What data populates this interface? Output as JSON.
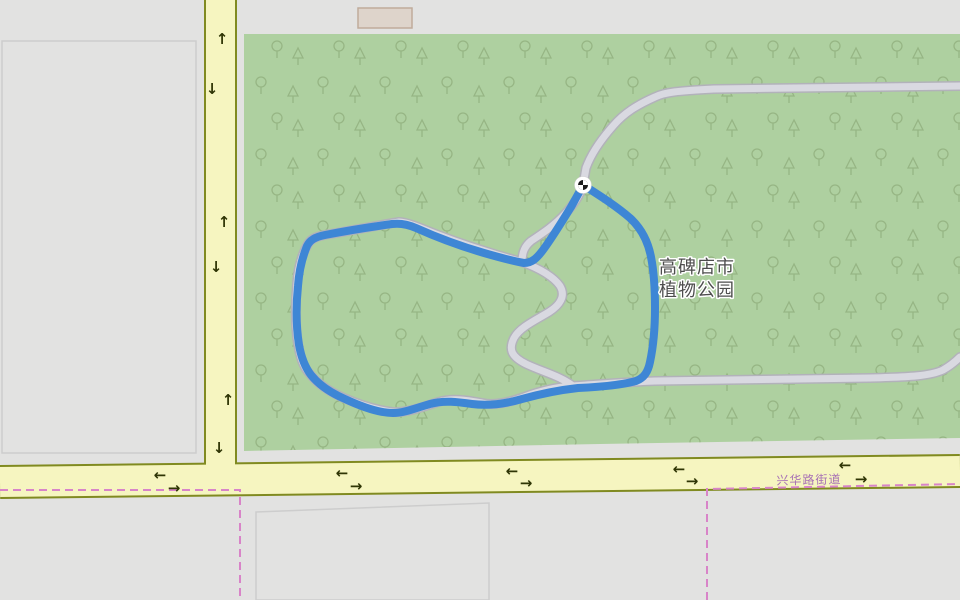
{
  "map": {
    "park_label": {
      "line1": "高碑店市",
      "line2": "植物公园"
    },
    "road_label": "兴华路街道",
    "marker_name": "route-start-checkered-marker"
  },
  "icons": {
    "arrow_left": "←",
    "arrow_right": "→",
    "arrow_up": "↑",
    "arrow_down": "↓"
  },
  "colors": {
    "background": "#e2e2e1",
    "park_green": "#aed0a0",
    "tree_outline": "#94b381",
    "road_fill": "#f6f5c0",
    "road_casing": "#808a20",
    "path_fill": "#d9d9e1",
    "path_casing": "#b2b2ba",
    "route_blue": "#3e86d5",
    "boundary_pink": "#d884c8",
    "building_fill": "#ded4cb",
    "building_stroke": "#c0ab9b",
    "parcel_stroke": "#cdcdcd",
    "park_label_color": "#4d4d4d",
    "road_label_color": "#a770b5",
    "arrow_color": "#2f3505",
    "marker_bg": "#ffffff",
    "marker_fg": "#1a1a1a"
  }
}
